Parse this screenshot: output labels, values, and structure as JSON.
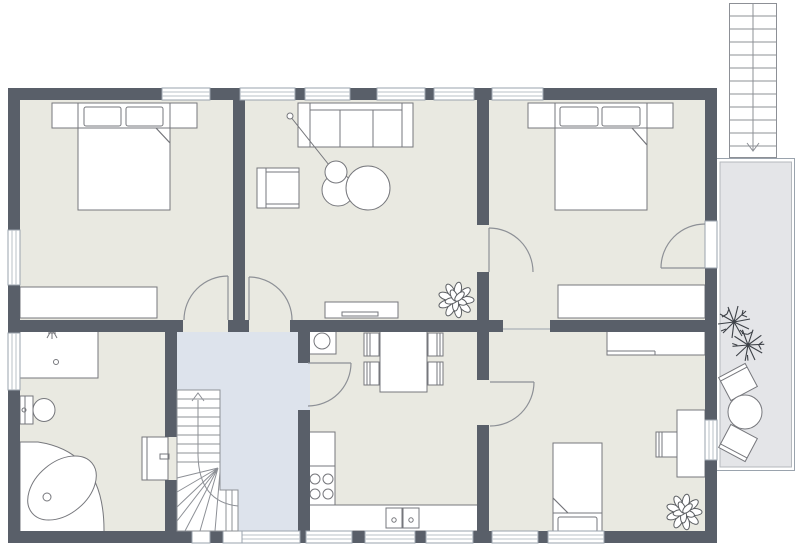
{
  "document": {
    "kind": "residential-floor-plan",
    "text_labels": []
  },
  "colors": {
    "background": "#ffffff",
    "floor": "#e9e9e1",
    "wall": "#595f69",
    "stairwell_floor": "#dde3ec",
    "terrace_floor": "#e4e5e8",
    "furniture_outline": "#76777c",
    "window_frame": "#9aa3ad",
    "plant_dark": "#3d4147"
  },
  "rooms": [
    {
      "id": "bedroom-top-left",
      "furniture": [
        "double-bed",
        "pillow",
        "pillow",
        "nightstand-left",
        "nightstand-right",
        "wardrobe"
      ],
      "windows": 2,
      "doors": [
        "door-to-landing"
      ]
    },
    {
      "id": "living-room",
      "furniture": [
        "sofa-3-seat",
        "armchair",
        "floor-lamp",
        "round-coffee-table-small",
        "round-coffee-table-large",
        "sideboard",
        "potted-plant"
      ],
      "windows": 4,
      "doors": [
        "door-to-landing",
        "door-to-bedroom-top-right"
      ]
    },
    {
      "id": "bedroom-top-right",
      "furniture": [
        "double-bed",
        "pillow",
        "pillow",
        "nightstand-left",
        "nightstand-right",
        "wardrobe"
      ],
      "windows": 1,
      "doors": [
        "door-from-living-room",
        "door-to-terrace"
      ]
    },
    {
      "id": "bathroom",
      "furniture": [
        "shower",
        "toilet",
        "corner-bathtub"
      ],
      "windows": 1,
      "doors": [
        "door-to-landing"
      ]
    },
    {
      "id": "stair-landing",
      "features": [
        "winder-staircase-up",
        "entry-below-stairs"
      ],
      "doors": [
        "door-to-bedroom-top-left",
        "door-to-living-room",
        "door-to-bathroom",
        "door-to-kitchen"
      ]
    },
    {
      "id": "kitchen-dining",
      "furniture": [
        "washing-machine",
        "dining-table",
        "chair",
        "chair",
        "chair",
        "chair",
        "base-cabinet",
        "stove-4-burner",
        "counter-with-double-sink"
      ],
      "windows": 3,
      "doors": [
        "door-from-landing",
        "door-to-bedroom-bottom-right"
      ]
    },
    {
      "id": "bedroom-bottom-right",
      "furniture": [
        "single-bed",
        "pillow",
        "wardrobe",
        "desk",
        "desk-chair",
        "potted-plant"
      ],
      "windows": 3,
      "doors": [
        "door-from-kitchen"
      ],
      "openings": [
        "passage-to-bedroom-top-right"
      ]
    },
    {
      "id": "terrace",
      "furniture": [
        "round-table",
        "terrace-chair",
        "terrace-chair",
        "spiky-plant",
        "spiky-plant"
      ],
      "features": [
        "external-staircase-down"
      ]
    }
  ]
}
